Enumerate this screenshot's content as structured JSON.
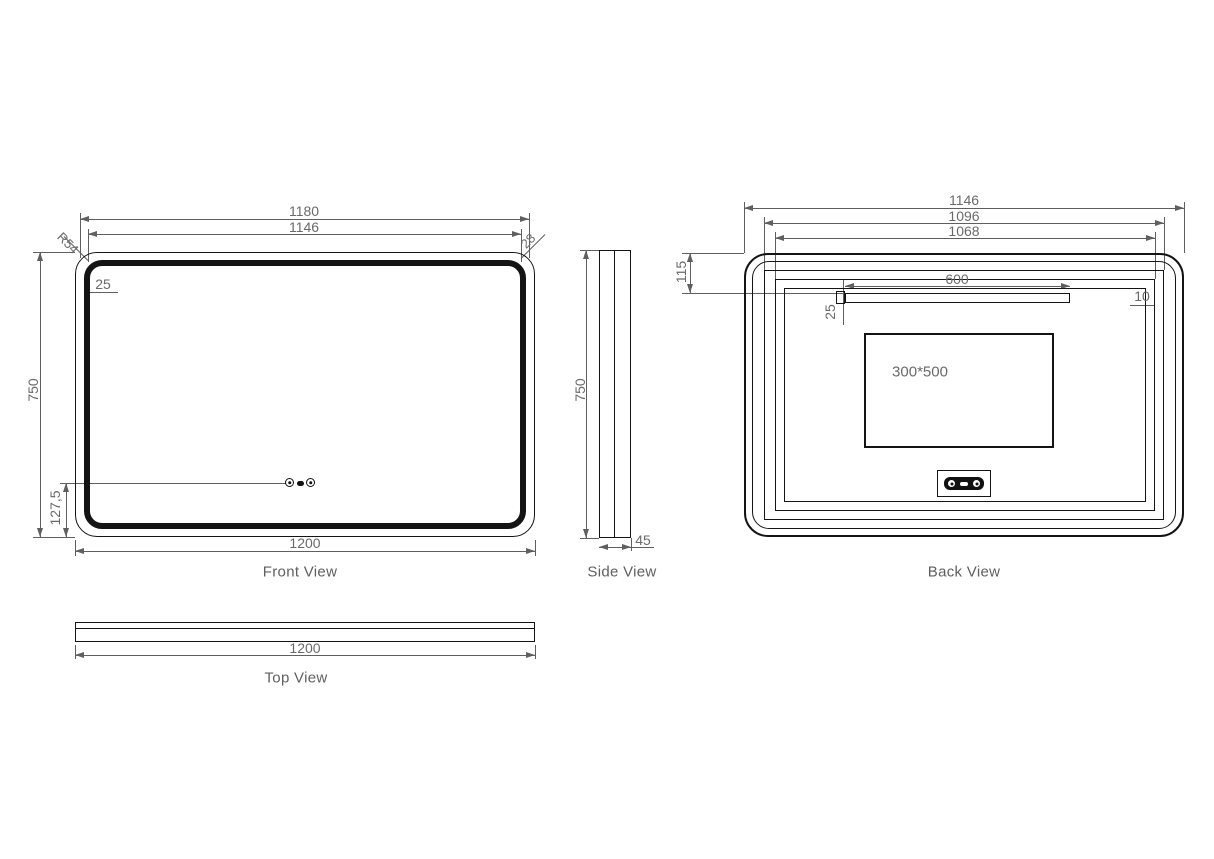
{
  "drawing": {
    "front_view": {
      "title": "Front View",
      "dims": {
        "overall_width": "1200",
        "led_width": "1180",
        "inner_width": "1146",
        "overall_height": "750",
        "sensor_height": "127,5",
        "frame_inset": "25",
        "corner_radius": "R54",
        "edge_offset": "28"
      }
    },
    "side_view": {
      "title": "Side View",
      "dims": {
        "height": "750",
        "depth": "45"
      }
    },
    "back_view": {
      "title": "Back View",
      "dims": {
        "overall_width": "1146",
        "frame_width": "1096",
        "inner_width": "1068",
        "bracket_width": "600",
        "bracket_height": "25",
        "edge_gap": "10",
        "bracket_top_offset": "115",
        "junction_box": "300*500"
      }
    },
    "top_view": {
      "title": "Top View",
      "dims": {
        "width": "1200"
      }
    }
  },
  "colors": {
    "object_line": "#141414",
    "dimension_line": "#5f5f5f",
    "text": "#6a6a6a"
  }
}
